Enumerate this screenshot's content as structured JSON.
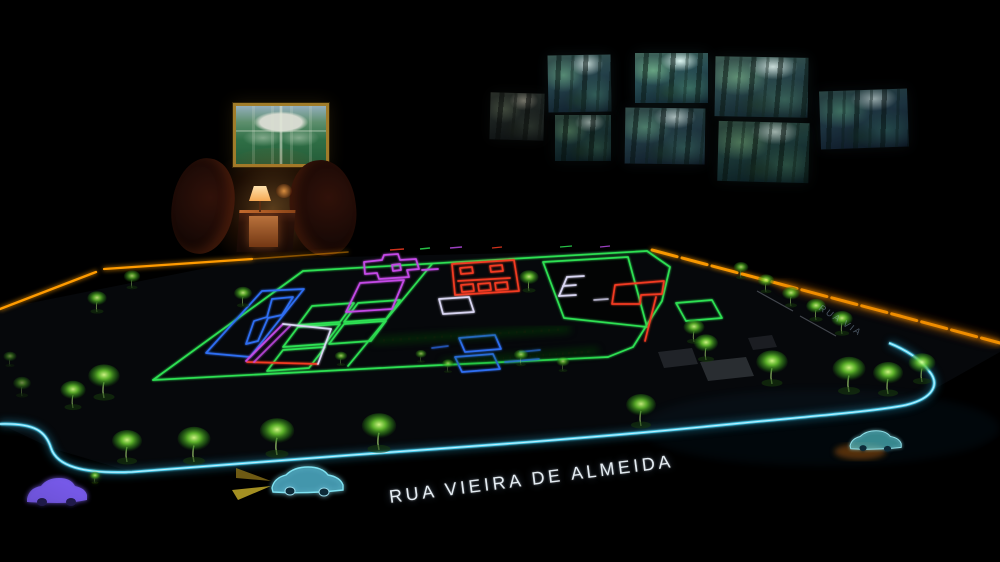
{
  "street_labels": {
    "main": "RUA VIEIRA DE ALMEIDA",
    "side": "RUA VIA"
  },
  "wall_display": {
    "screen_count": 8,
    "content": "forest footage"
  },
  "framed_picture": {
    "content": "aerial view of formal gardens"
  },
  "lounge": {
    "furniture": [
      "armchair",
      "side table with lamp",
      "armchair"
    ]
  },
  "model_table": {
    "tree_count": 28,
    "cars": {
      "purple": 1,
      "cyan": 2
    },
    "edge_lighting": "amber LED strip",
    "street_outline": "cyan neon"
  },
  "palette": {
    "neon_cyan": "#4ed2f2",
    "neon_green": "#2de052",
    "neon_blue": "#2f6ef2",
    "neon_red": "#f23a20",
    "neon_magenta": "#c44ae6",
    "neon_lavender": "#d9d6f2",
    "led_amber": "#ff9b00",
    "tree_green": "#5cc832",
    "car_purple": "#7a5cf0",
    "car_cyan": "#63cfe2",
    "lamp_warm": "#ffc06a",
    "frame_gold": "#a07c2a",
    "label_white": "#e4ecf2"
  }
}
